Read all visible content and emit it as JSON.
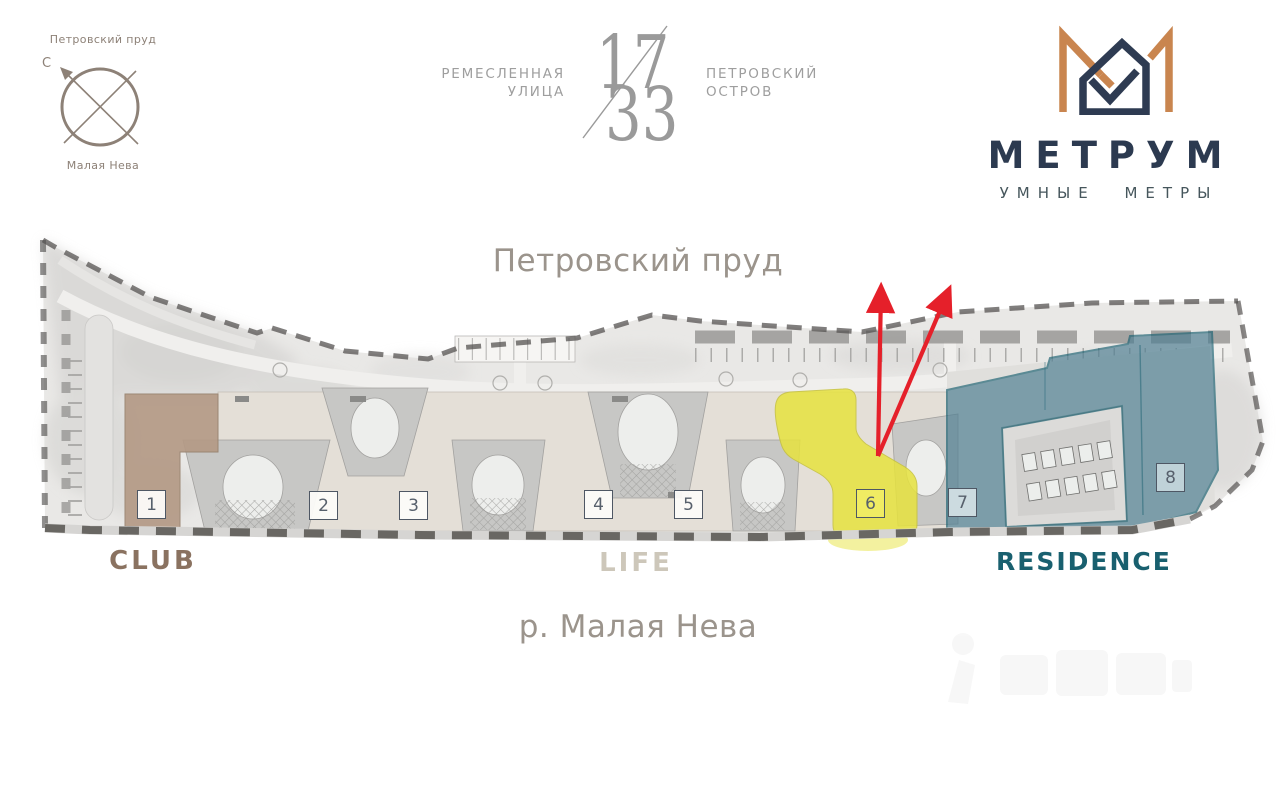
{
  "compass": {
    "top_label": "Петровский пруд",
    "north_label": "С",
    "bottom_label": "Малая Нева"
  },
  "project": {
    "street_line1": "РЕМЕСЛЕННАЯ",
    "street_line2": "УЛИЦА",
    "number_top": "17",
    "number_bottom": "33",
    "location_line1": "ПЕТРОВСКИЙ",
    "location_line2": "ОСТРОВ"
  },
  "brand": {
    "name": "МЕТРУМ",
    "tagline": "УМНЫЕ МЕТРЫ"
  },
  "plan": {
    "north_water_label": "Петровский пруд",
    "south_water_label": "р. Малая Нева",
    "zones": {
      "club": "CLUB",
      "life": "LIFE",
      "residence": "RESIDENCE"
    },
    "buildings": [
      {
        "label": "1",
        "zone": "CLUB"
      },
      {
        "label": "2",
        "zone": "LIFE"
      },
      {
        "label": "3",
        "zone": "LIFE"
      },
      {
        "label": "4",
        "zone": "LIFE"
      },
      {
        "label": "5",
        "zone": "LIFE"
      },
      {
        "label": "6",
        "zone": "LIFE"
      },
      {
        "label": "7",
        "zone": "RESIDENCE"
      },
      {
        "label": "8",
        "zone": "RESIDENCE"
      }
    ],
    "colors": {
      "club_highlight": "#b49a86",
      "life_highlight": "#e7e33f",
      "residence_highlight": "#4e7e92",
      "residence_outline": "#1d6273",
      "club_label": "#8a7260",
      "life_label": "#cdc7ba",
      "residence_label": "#19606f",
      "arrow_red": "#e5202a",
      "water_label": "#9b948c",
      "brand_navy": "#2c3a50",
      "brand_orange": "#c9854f"
    }
  }
}
